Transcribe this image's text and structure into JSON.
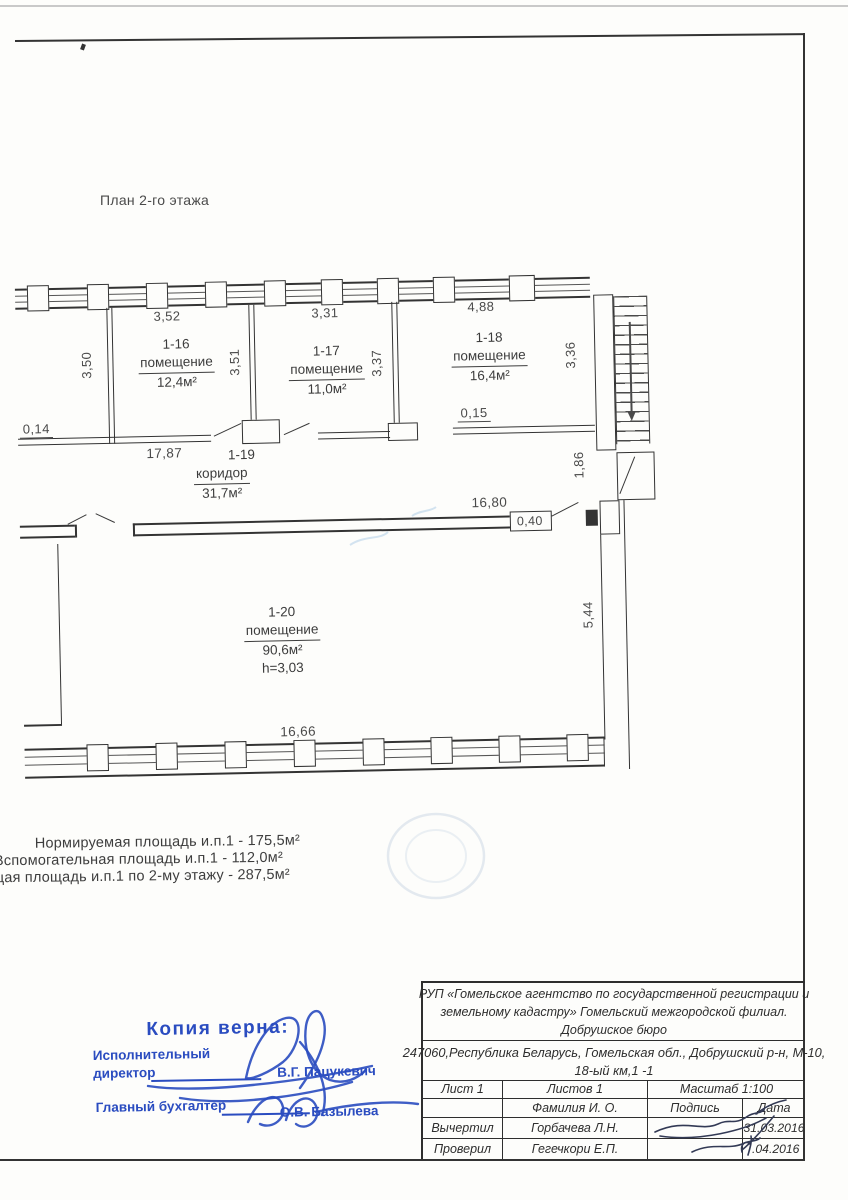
{
  "document": {
    "plan_title": "План 2-го этажа"
  },
  "plan": {
    "rooms": [
      {
        "id": "1-16",
        "type": "помещение",
        "area": "12,4м²"
      },
      {
        "id": "1-17",
        "type": "помещение",
        "area": "11,0м²"
      },
      {
        "id": "1-18",
        "type": "помещение",
        "area": "16,4м²"
      },
      {
        "id": "1-19",
        "type": "коридор",
        "area": "31,7м²"
      },
      {
        "id": "1-20",
        "type": "помещение",
        "area": "90,6м²",
        "ceiling_height": "h=3,03"
      }
    ],
    "dims": {
      "room_1_16_width": "3,52",
      "room_1_17_width": "3,31",
      "room_1_18_width": "4,88",
      "room_1_16_depth": "3,50",
      "wall_1_16_1_17": "3,51",
      "wall_1_17_1_18": "3,37",
      "room_1_18_depth": "3,36",
      "wall_thickness_left": "0,14",
      "corridor_length": "17,87",
      "wall_thickness_right": "0,15",
      "corridor_width_right": "1,86",
      "hall_wall_length": "16,80",
      "wall_thickness_hall": "0,40",
      "hall_depth": "5,44",
      "bottom_wall_length": "16,66"
    }
  },
  "summary": {
    "line1": "Нормируемая площадь и.п.1 - 175,5м²",
    "line2": "Вспомогательная площадь и.п.1 - 112,0м²",
    "line3": "Общая площадь и.п.1 по 2-му этажу - 287,5м²"
  },
  "stamp": {
    "title": "Копия верна:",
    "role1_line1": "Исполнительный",
    "role1_line2": "директор",
    "name1": "В.Г. Пацукевич",
    "role2": "Главный бухгалтер",
    "name2": "О.В. Базылева",
    "ink_color": "#2a4cc0"
  },
  "title_block": {
    "org_line1": "РУП «Гомельское агентство по государственной регистрации и",
    "org_line2": "земельному кадастру» Гомельский межгородской филиал.",
    "org_line3": "Добрушское бюро",
    "address_line1": "247060,Республика Беларусь, Гомельская обл., Добрушский р-н, М-10,",
    "address_line2": "18-ый км,1 -1",
    "sheet": "Лист 1",
    "sheets": "Листов 1",
    "scale": "Масштаб 1:100",
    "col_name": "Фамилия И. О.",
    "col_sign": "Подпись",
    "col_date": "Дата",
    "rows": [
      {
        "role": "Вычертил",
        "name": "Горбачева Л.Н.",
        "date": "31.03.2016"
      },
      {
        "role": "Проверил",
        "name": "Гегечкори Е.П.",
        "date": ".04.2016"
      }
    ]
  }
}
